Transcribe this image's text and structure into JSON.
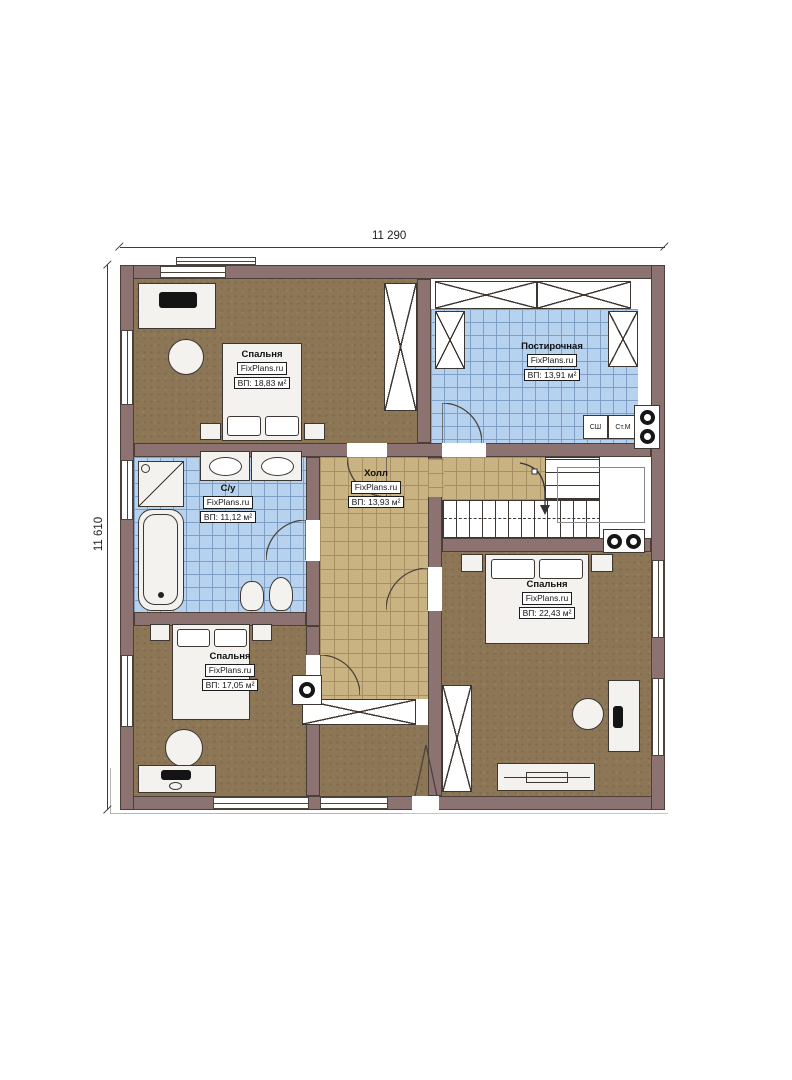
{
  "brand": "FixPlans.ru",
  "dimensions": {
    "width_label": "11 290",
    "height_label": "11 610"
  },
  "rooms": [
    {
      "id": "bedroom-top-left",
      "name": "Спальня",
      "brand": "FixPlans.ru",
      "area": "ВП: 18,83 м²"
    },
    {
      "id": "laundry",
      "name": "Постирочная",
      "brand": "FixPlans.ru",
      "area": "ВП: 13,91 м²"
    },
    {
      "id": "bathroom",
      "name": "С/у",
      "brand": "FixPlans.ru",
      "area": "ВП: 11,12 м²"
    },
    {
      "id": "hall",
      "name": "Холл",
      "brand": "FixPlans.ru",
      "area": "ВП: 13,93 м²"
    },
    {
      "id": "bedroom-right",
      "name": "Спальня",
      "brand": "FixPlans.ru",
      "area": "ВП: 22,43 м²"
    },
    {
      "id": "bedroom-bottom-left",
      "name": "Спальня",
      "brand": "FixPlans.ru",
      "area": "ВП: 17,05 м²"
    }
  ],
  "appliances": {
    "washer_label": "СШ",
    "dryer_label": "Ст.М"
  },
  "colors": {
    "wall": "#8c7372",
    "floor_brown": "#8c7656",
    "tile_blue": "#b6d2ee",
    "tile_blue_grid": "#7fa0c6",
    "tile_tan": "#c9b383",
    "tile_tan_grid": "#a78f62",
    "furniture": "#f3f2ef",
    "outline": "#3e3630"
  }
}
